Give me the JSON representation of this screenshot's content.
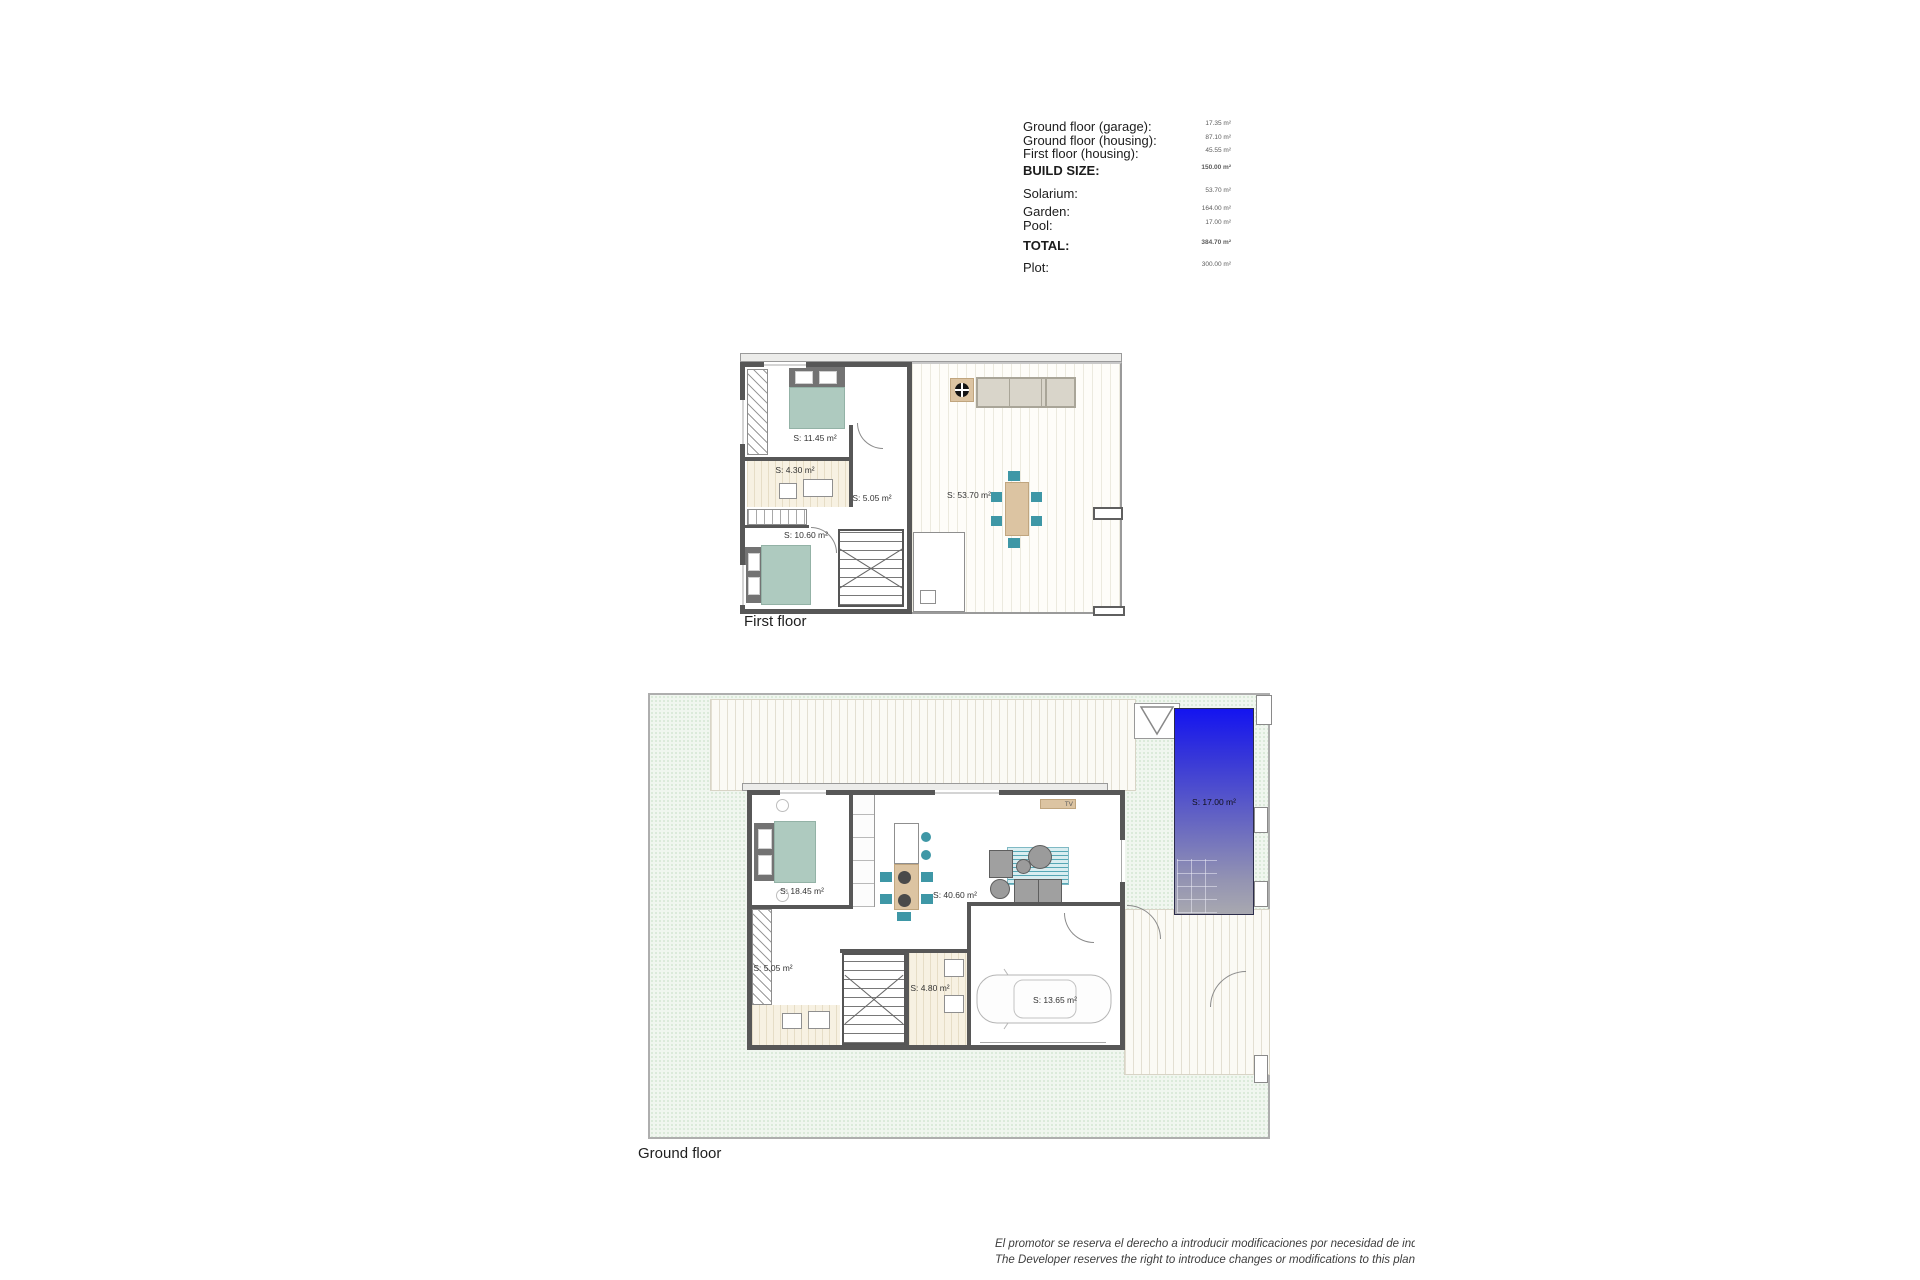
{
  "area_table": {
    "rows": [
      {
        "label": "Ground floor (garage):",
        "value": "17.35 m²"
      },
      {
        "label": "Ground floor (housing):",
        "value": "87.10 m²"
      },
      {
        "label": "First floor (housing):",
        "value": "45.55 m²"
      },
      {
        "label": "BUILD SIZE:",
        "value": "150.00 m²"
      },
      {
        "label": "Solarium:",
        "value": "53.70 m²"
      },
      {
        "label": "Garden:",
        "value": "164.00 m²"
      },
      {
        "label": "Pool:",
        "value": "17.00 m²"
      },
      {
        "label": "TOTAL:",
        "value": "384.70 m²"
      },
      {
        "label": "Plot:",
        "value": "300.00 m²"
      }
    ]
  },
  "first_floor": {
    "title": "First floor",
    "rooms": {
      "bedroom1": "S: 11.45 m²",
      "bathroom": "S: 4.30 m²",
      "hall": "S: 5.05 m²",
      "bedroom2": "S: 10.60 m²",
      "solarium": "S: 53.70 m²"
    }
  },
  "ground_floor": {
    "title": "Ground floor",
    "tv_label": "TV",
    "rooms": {
      "bedroom": "S: 18.45 m²",
      "living": "S: 40.60 m²",
      "bathroom": "S: 5.05 m²",
      "laundry": "S: 4.80 m²",
      "garage": "S: 13.65 m²",
      "pool": "S: 17.00 m²"
    }
  },
  "disclaimer": {
    "line1": "El promotor se reserva el derecho a introducir modificaciones por necesidad de indole técnica o leg",
    "line2": "The Developer reserves the right to introduce changes or modifications to this plan due to legal or t"
  },
  "colors": {
    "wall_gray": "#575757",
    "accent_teal": "#3e97a6",
    "bed_sage": "#aecabf",
    "wood_tan": "#dcc4a2",
    "pool_top": "#1414f0",
    "pool_bottom": "#a8a8b0",
    "garden_dot": "#a9cea9"
  }
}
